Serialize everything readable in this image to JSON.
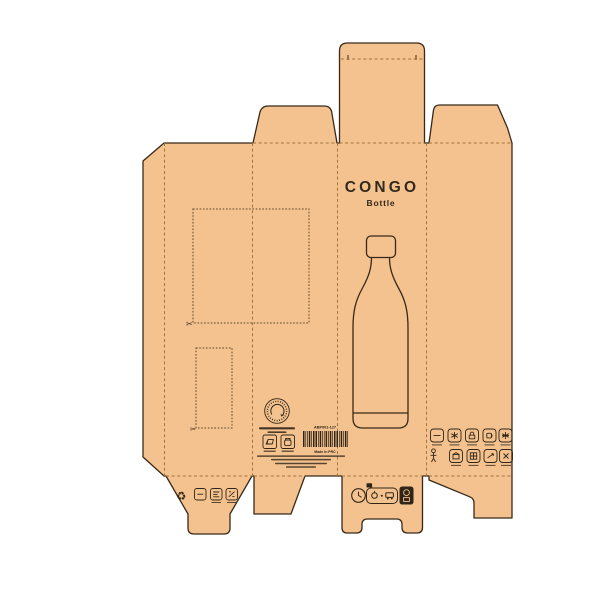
{
  "panel_front": {
    "title": "CONGO",
    "subtitle": "Bottle"
  },
  "panel_info": {
    "product_code": "ABP001-127",
    "origin_label": "Made in PRC"
  },
  "glyphs": {
    "scissors": "✂",
    "recycle": "♻"
  },
  "colors": {
    "kraft": "#f3c28e",
    "cut_line": "#38291a",
    "fold_line": "#a1743c",
    "ink": "#312518",
    "background": "#ffffff"
  },
  "icons": {
    "stamp": "recycle-stamp-icon",
    "separation_icons": [
      "carton-icon",
      "jar-icon"
    ],
    "barcode": "barcode",
    "disposal_row": [
      "recycle-triangle-icon",
      "material-box-icon-1",
      "material-box-icon-2",
      "material-box-icon-3"
    ],
    "certification_row": [
      "clock-icon",
      "sorting-pill-badge",
      "dark-qr-badge"
    ],
    "feature_grid": [
      "flat-icon",
      "snowflake-icon",
      "lock-icon",
      "cup-icon",
      "sun-icon",
      "person-icon",
      "box-icon",
      "pattern-box-icon",
      "arrow-icon",
      "crossed-box-icon"
    ],
    "cutouts": "scissors-icon"
  }
}
